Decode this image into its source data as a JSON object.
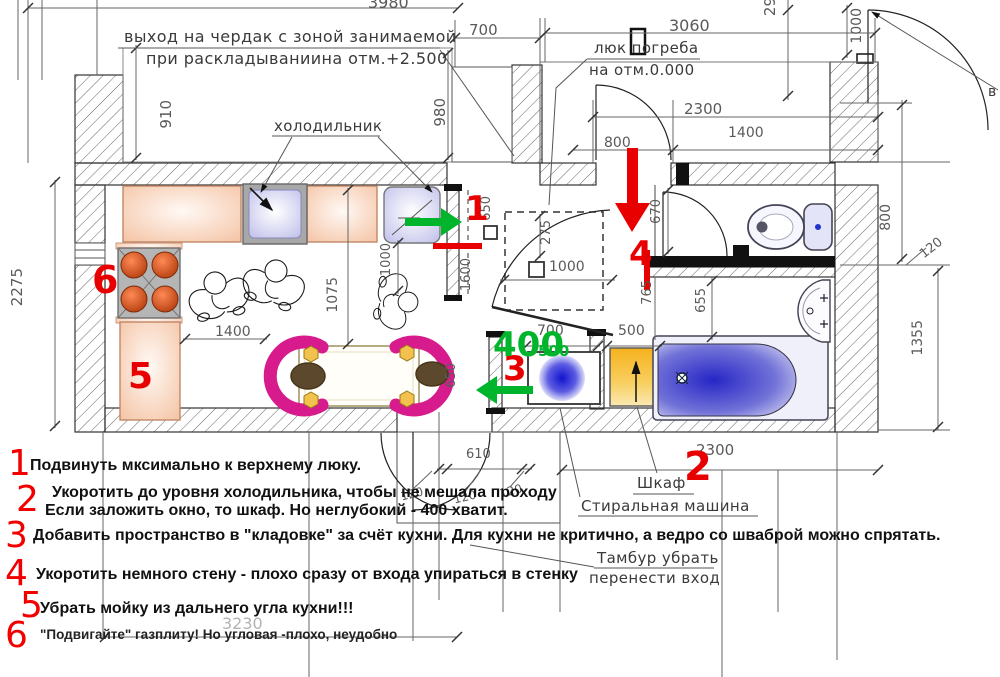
{
  "labels": {
    "attic_line1": "выход на чердак с зоной занимаемой",
    "attic_line2": "при раскладываниина отм.+2.500",
    "fridge": "холодильник",
    "cellar_line1": "люк погреба",
    "cellar_line2": "на отм.0.000",
    "wardrobe": "Шкаф",
    "washing_machine": "Стиральная машина",
    "tambour": "Тамбур убрать",
    "entrance": "перенести вход",
    "right_edge_cut": "в"
  },
  "dims": {
    "t3980": "3980",
    "t700": "700",
    "t3060": "3060",
    "t29": "29",
    "t1000r": "1000",
    "h2300": "2300",
    "h1400": "1400",
    "h800": "800",
    "l910": "910",
    "l2275": "2275",
    "m980": "980",
    "s650": "650",
    "k1000": "1000",
    "k1600": "1600",
    "k1075": "1075",
    "k1400": "1400",
    "c275": "275",
    "c1000": "1000",
    "t670": "670",
    "r800": "800",
    "r120": "120",
    "r1355": "1355",
    "b765": "765",
    "b655": "655",
    "w700": "700",
    "w500": "500",
    "s650b": "650",
    "g610": "610",
    "g120a": "120",
    "g120b": "120",
    "g120c": "120",
    "g2300": "2300",
    "g3230": "3230"
  },
  "markers": {
    "plan1": "1",
    "plan2": "2",
    "plan3": "3",
    "plan4": "4",
    "plan5": "5",
    "plan6": "6",
    "green400": "400",
    "green500": "500"
  },
  "notes": {
    "n1": {
      "num": "1",
      "text": "Подвинуть мксимально к верхнему люку."
    },
    "n2": {
      "num": "2",
      "line1": "Укоротить до уровня холодильника, чтобы не мешала проходу",
      "line2": "Если заложить окно, то шкаф. Но неглубокий - 400 хватит."
    },
    "n3": {
      "num": "3",
      "text": "Добавить пространство в \"кладовке\" за счёт кухни. Для кухни не критично, а ведро со шваброй можно спрятать."
    },
    "n4": {
      "num": "4",
      "text": "Укоротить немного стену - плохо сразу от входа упираться в стенку"
    },
    "n5": {
      "num": "5",
      "text": "Убрать мойку из дальнего угла кухни!!!"
    },
    "n6": {
      "num": "6",
      "text": "\"Подвигайте\" газплиту! Но угловая -плохо, неудобно"
    }
  },
  "colors": {
    "annotation_red": "#e80000",
    "annotation_green": "#00b52c",
    "counter_peach": "#f5c6a8",
    "appliance_lavender": "#c9c9ef",
    "chair_magenta": "#d81b8c",
    "bath_blue": "#2828c8",
    "wardrobe_yellow": "#f6b82a"
  }
}
